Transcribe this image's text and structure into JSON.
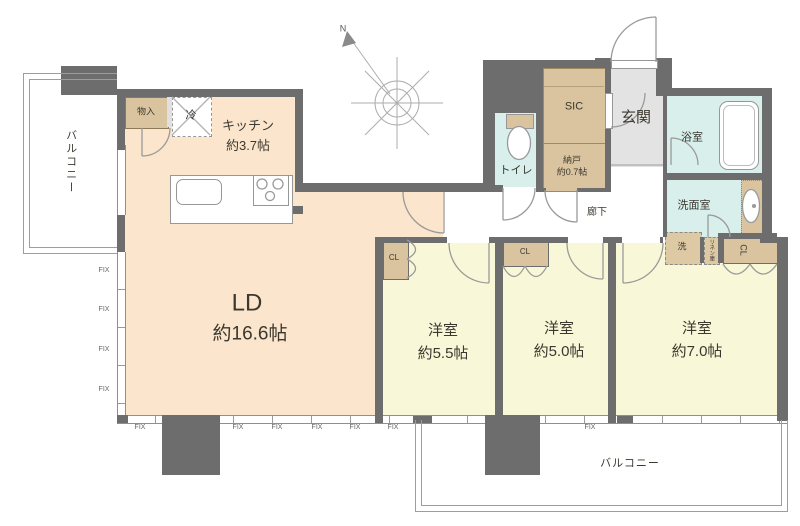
{
  "colors": {
    "wall": "#6d6d6d",
    "living_floor": "#fbe5cc",
    "bedroom_floor": "#f8f8d8",
    "wet_area_floor": "#d8efec",
    "closet_fill": "#d9c49f",
    "entrance_floor": "#e3e3e3",
    "line": "#9a9a9a",
    "text": "#3b382f"
  },
  "labels": {
    "fix": "FIX",
    "north": "N"
  },
  "rooms": {
    "balcony_left": {
      "name": "バルコニー"
    },
    "closet_entry": {
      "name": "物入"
    },
    "refrigerator": {
      "name": "冷"
    },
    "kitchen": {
      "name": "キッチン",
      "size": "約3.7帖"
    },
    "living_dining": {
      "name": "LD",
      "size": "約16.6帖"
    },
    "toilet": {
      "name": "トイレ"
    },
    "shoe_closet": {
      "name": "SIC"
    },
    "storage": {
      "name": "納戸",
      "size": "約0.7帖"
    },
    "entrance": {
      "name": "玄関"
    },
    "hallway": {
      "name": "廊下"
    },
    "bathroom": {
      "name": "浴室"
    },
    "washroom": {
      "name": "洗面室"
    },
    "washer": {
      "name": "洗"
    },
    "linen": {
      "name": "リネン庫"
    },
    "closet1": {
      "name": "CL"
    },
    "closet2": {
      "name": "CL"
    },
    "closet3": {
      "name": "CL"
    },
    "bedroom1": {
      "name": "洋室",
      "size": "約5.5帖"
    },
    "bedroom2": {
      "name": "洋室",
      "size": "約5.0帖"
    },
    "bedroom3": {
      "name": "洋室",
      "size": "約7.0帖"
    },
    "balcony_main": {
      "name": "バルコニー"
    }
  }
}
